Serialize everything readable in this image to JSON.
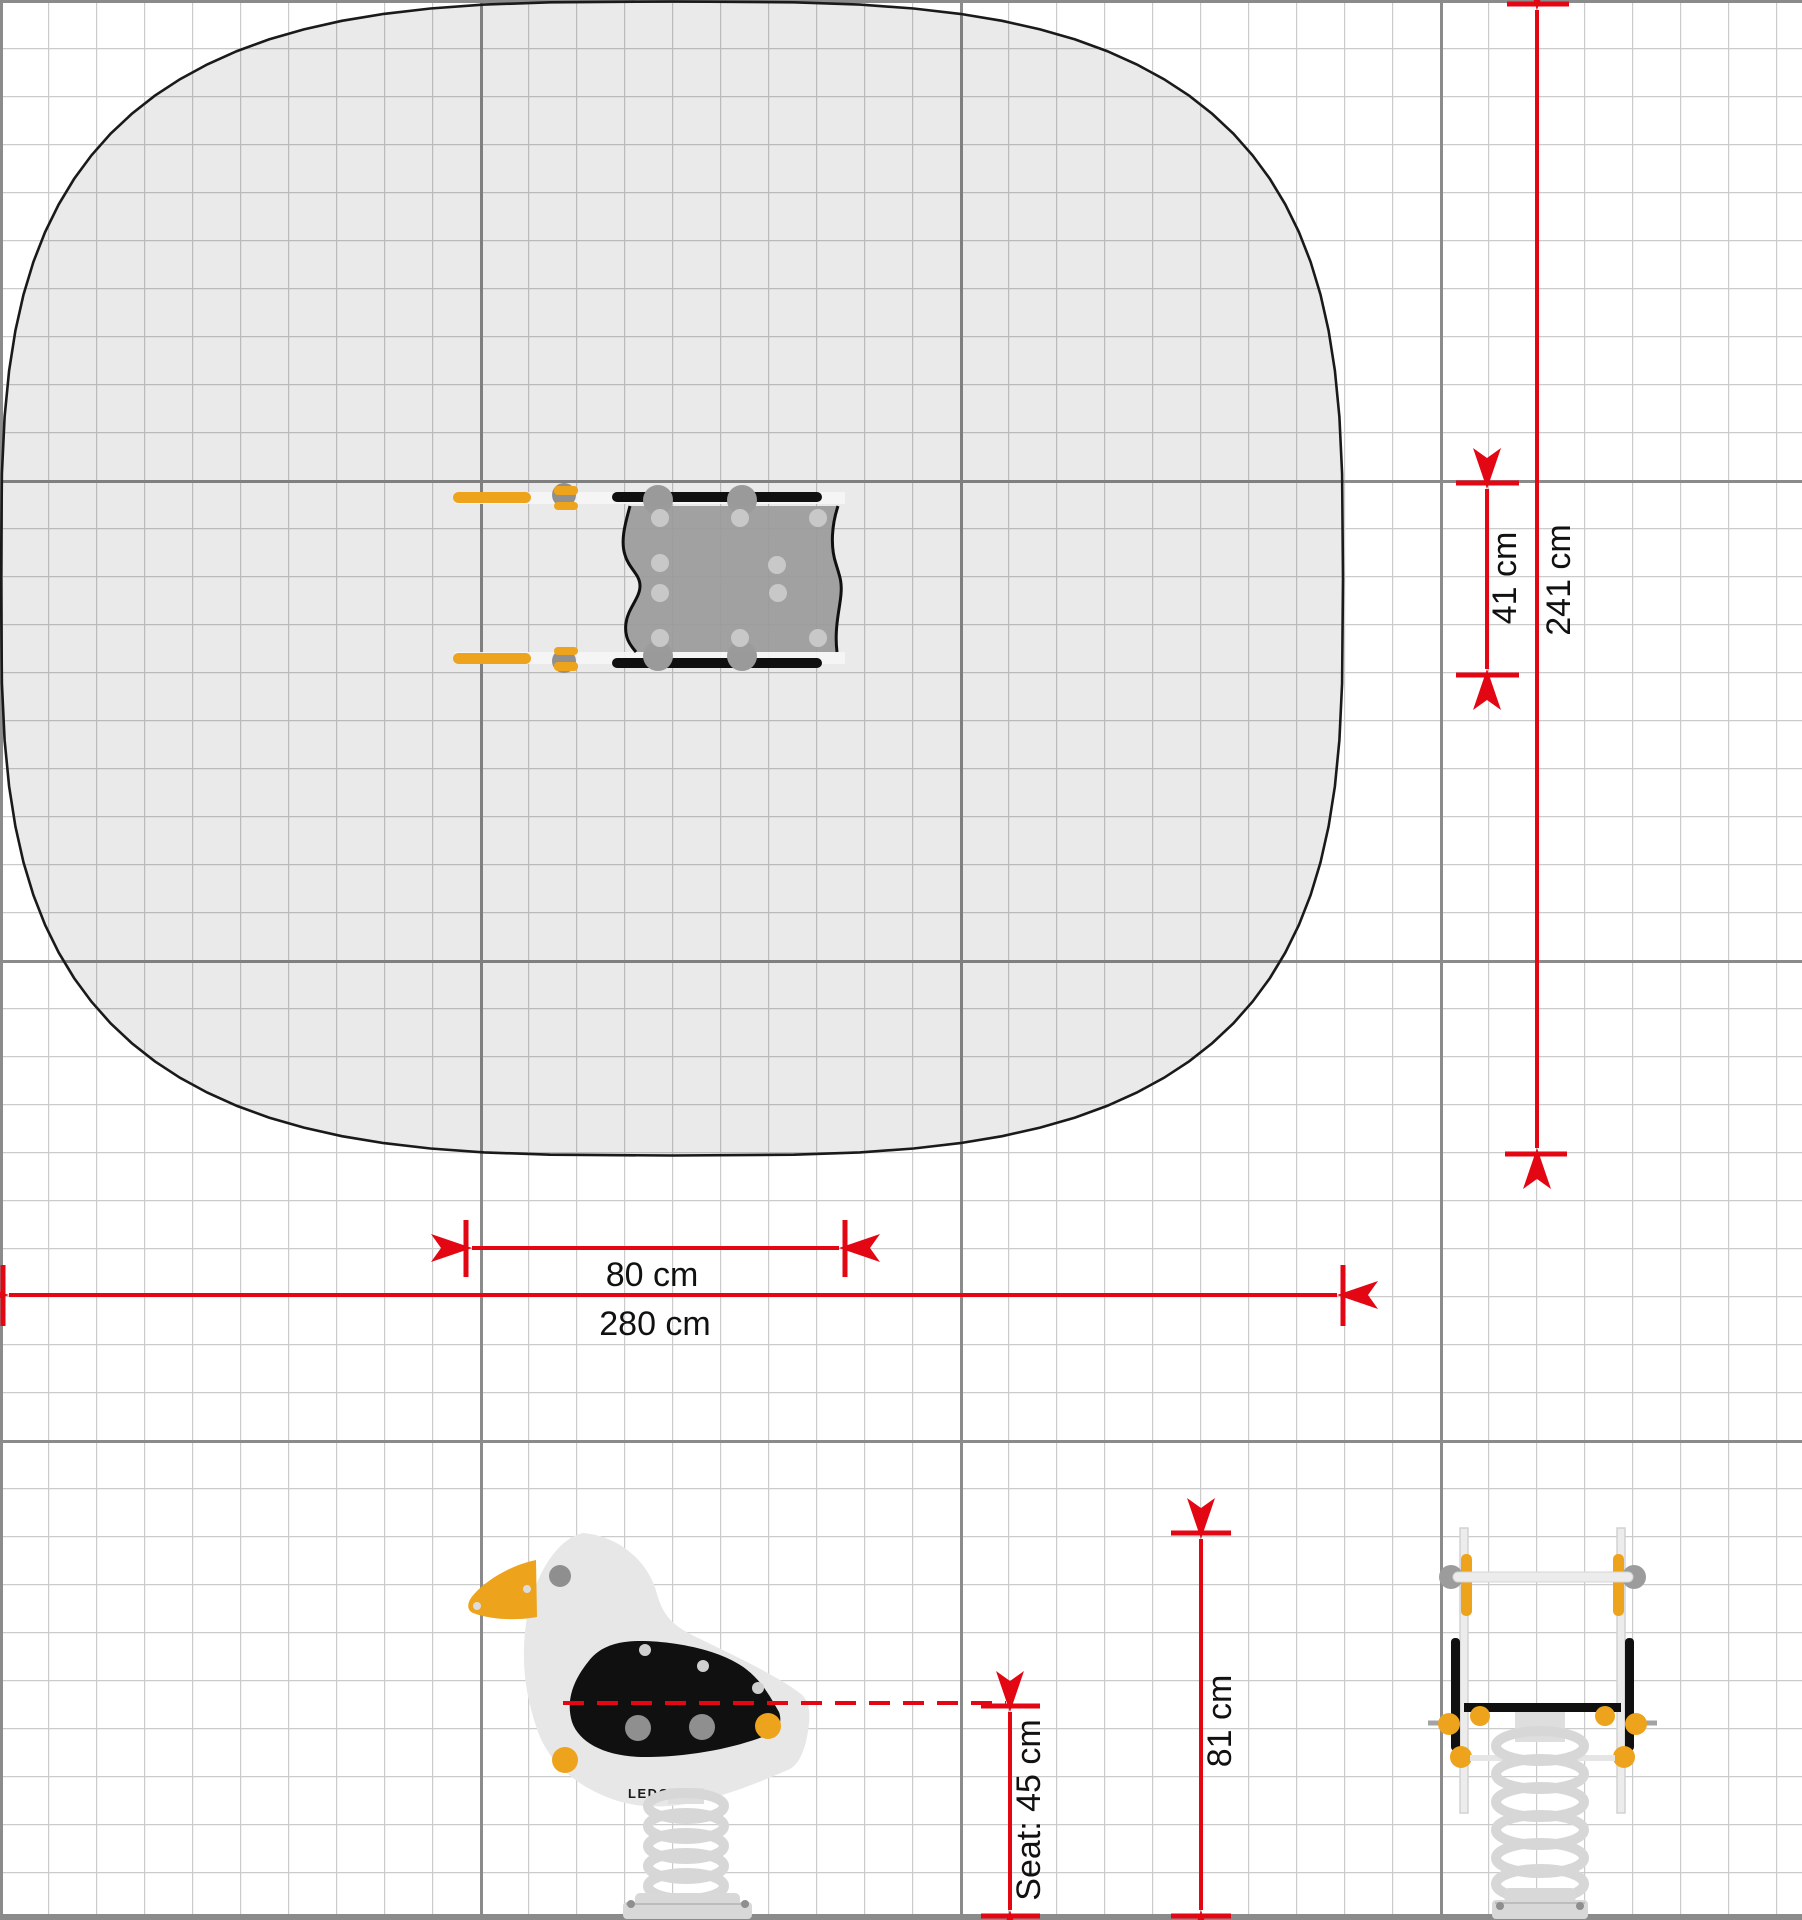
{
  "drawing": {
    "brand_logo": "LEDON",
    "dimensions": {
      "safety_zone_width": "280 cm",
      "safety_zone_depth": "241 cm",
      "equipment_length": "80 cm",
      "equipment_width": "41 cm",
      "total_height": "81 cm",
      "seat_height": "Seat: 45 cm"
    },
    "colors": {
      "dimension_red": "#e30613",
      "accent_yellow": "#eda41c",
      "equipment_gray": "#9b9b9b",
      "wing_black": "#101010",
      "body_light_gray": "#e7e7e7",
      "zone_outline": "#1a1a1a",
      "grid_minor": "#cbcbcb",
      "grid_major": "#8b8b8b"
    }
  }
}
